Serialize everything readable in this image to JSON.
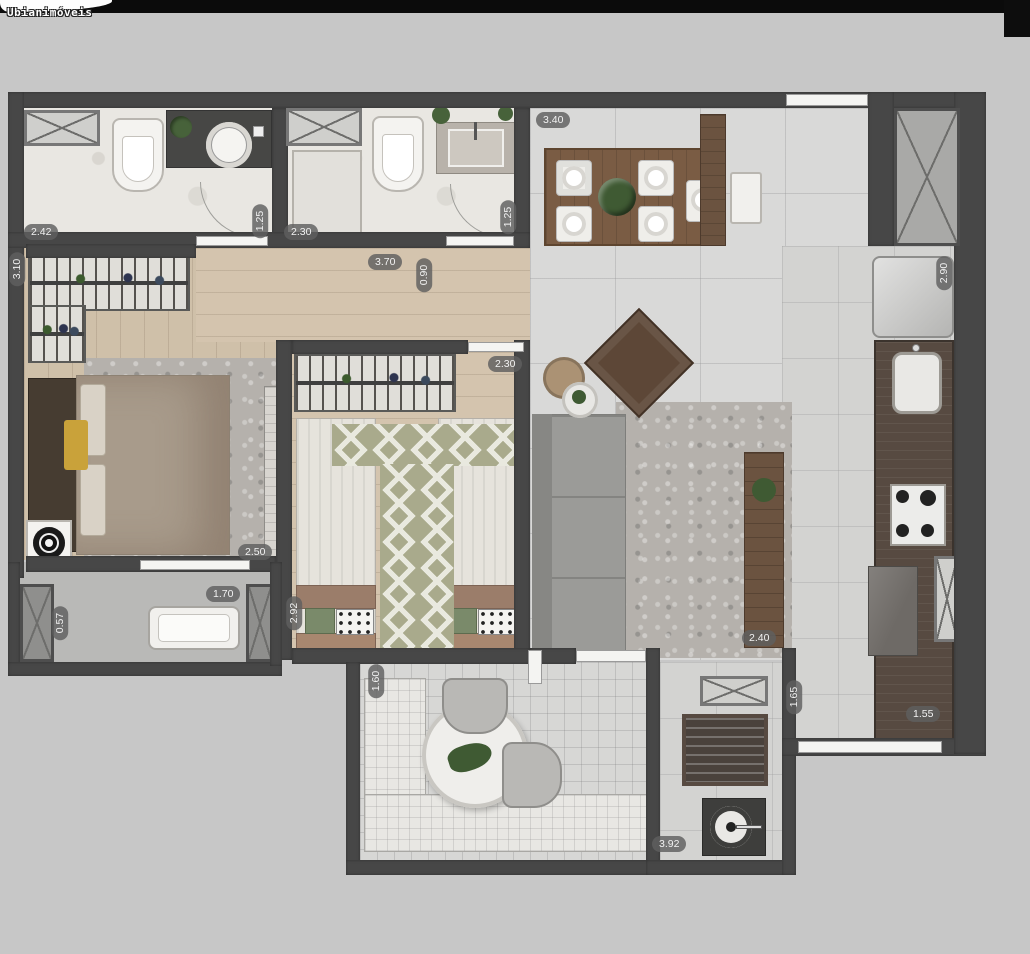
{
  "watermark": {
    "text": "Ubianimóveis"
  },
  "colors": {
    "background": "#c7c7c7",
    "top_bar": "#0b0b0b",
    "wall": "#474747",
    "wood_floor": "#cfc0a9",
    "tile_floor": "#d9d9d8",
    "marble": "#e9e7e2",
    "counter_wood": "#574a41",
    "dining_table": "#7a5c44",
    "sofa": "#9b9b98",
    "runner_green": "#a9aa8c",
    "label_bg": "rgba(95,95,95,0.82)",
    "label_text": "#f2f2f2"
  },
  "plan": {
    "dimension_labels": [
      {
        "value": "2.42",
        "orientation": "horizontal",
        "x": 24,
        "y": 224
      },
      {
        "value": "1.25",
        "orientation": "vertical",
        "x": 243,
        "y": 213
      },
      {
        "value": "2.30",
        "orientation": "horizontal",
        "x": 284,
        "y": 224
      },
      {
        "value": "1.25",
        "orientation": "vertical",
        "x": 491,
        "y": 209
      },
      {
        "value": "3.40",
        "orientation": "horizontal",
        "x": 536,
        "y": 112
      },
      {
        "value": "3.70",
        "orientation": "horizontal",
        "x": 368,
        "y": 254
      },
      {
        "value": "0.90",
        "orientation": "vertical",
        "x": 407,
        "y": 267
      },
      {
        "value": "3.10",
        "orientation": "vertical",
        "x": 0,
        "y": 261
      },
      {
        "value": "2.30",
        "orientation": "horizontal",
        "x": 488,
        "y": 356
      },
      {
        "value": "2.90",
        "orientation": "vertical",
        "x": 927,
        "y": 265
      },
      {
        "value": "2.50",
        "orientation": "horizontal",
        "x": 238,
        "y": 544
      },
      {
        "value": "1.70",
        "orientation": "horizontal",
        "x": 206,
        "y": 586
      },
      {
        "value": "0.57",
        "orientation": "vertical",
        "x": 43,
        "y": 615
      },
      {
        "value": "2.92",
        "orientation": "vertical",
        "x": 277,
        "y": 605
      },
      {
        "value": "2.40",
        "orientation": "horizontal",
        "x": 742,
        "y": 630
      },
      {
        "value": "1.60",
        "orientation": "vertical",
        "x": 359,
        "y": 673
      },
      {
        "value": "1.65",
        "orientation": "vertical",
        "x": 777,
        "y": 689
      },
      {
        "value": "1.55",
        "orientation": "horizontal",
        "x": 906,
        "y": 706
      },
      {
        "value": "3.92",
        "orientation": "horizontal",
        "x": 652,
        "y": 836
      }
    ]
  }
}
